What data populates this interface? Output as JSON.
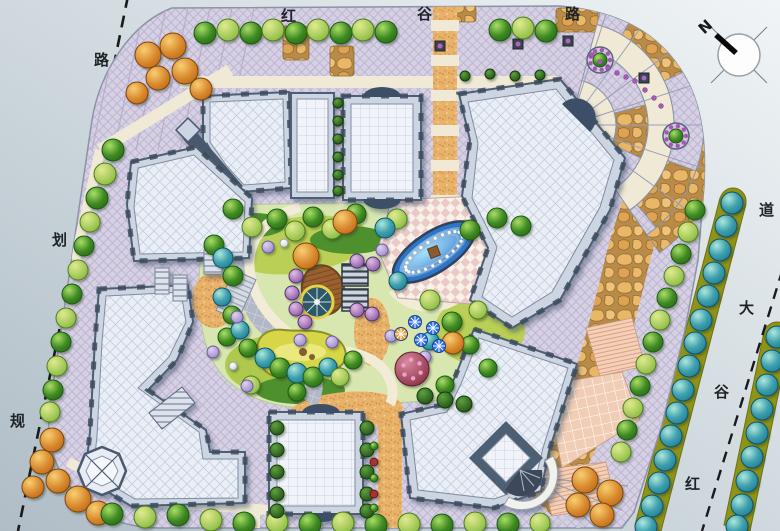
{
  "roads": {
    "top": {
      "name": "红谷路",
      "chars": [
        "红",
        "谷",
        "路"
      ]
    },
    "left": {
      "name": "规划路",
      "chars": [
        "路",
        "划",
        "规"
      ]
    },
    "right": {
      "name": "红谷大道",
      "chars": [
        "道",
        "大",
        "谷",
        "红"
      ]
    }
  },
  "compass": {
    "north_label": "N"
  },
  "palette": {
    "road_bg_dark": "#b5c1c9",
    "road_bg_light": "#eef2f5",
    "paving_lavender": "#d6d0e3",
    "paving_cream": "#efe9d5",
    "flagstone": "#e2a75f",
    "gravel": "#e9b26b",
    "roof_light": "#eaeef6",
    "roof_frame": "#4e5e72",
    "water_blue": "#2a70cc",
    "pond_green": "#d6d648",
    "lawn_green": "#b9cf55",
    "tree_green": "#3e8a22",
    "tree_teal": "#1f7f96",
    "tree_orange": "#c06a18",
    "tree_purple": "#8a55a0",
    "median_olive": "#8f9318",
    "umbrella_blue": "#2f6fe8",
    "dash_line": "#1a1a1a"
  },
  "trees": [
    [
      205,
      33,
      11,
      "g"
    ],
    [
      228,
      30,
      11,
      "l"
    ],
    [
      251,
      33,
      11,
      "g"
    ],
    [
      273,
      30,
      11,
      "l"
    ],
    [
      296,
      33,
      11,
      "g"
    ],
    [
      318,
      30,
      11,
      "l"
    ],
    [
      341,
      33,
      11,
      "g"
    ],
    [
      363,
      30,
      11,
      "l"
    ],
    [
      386,
      32,
      11,
      "g"
    ],
    [
      500,
      30,
      11,
      "g"
    ],
    [
      523,
      28,
      11,
      "l"
    ],
    [
      546,
      31,
      11,
      "g"
    ],
    [
      148,
      55,
      13,
      "o"
    ],
    [
      173,
      46,
      13,
      "o"
    ],
    [
      158,
      78,
      12,
      "o"
    ],
    [
      185,
      71,
      13,
      "o"
    ],
    [
      201,
      89,
      11,
      "o"
    ],
    [
      137,
      93,
      11,
      "o"
    ],
    [
      113,
      150,
      11,
      "g"
    ],
    [
      105,
      174,
      11,
      "l"
    ],
    [
      97,
      198,
      11,
      "g"
    ],
    [
      90,
      222,
      10,
      "l"
    ],
    [
      84,
      246,
      10,
      "g"
    ],
    [
      78,
      270,
      10,
      "l"
    ],
    [
      72,
      294,
      10,
      "g"
    ],
    [
      66,
      318,
      10,
      "l"
    ],
    [
      61,
      342,
      10,
      "g"
    ],
    [
      57,
      366,
      10,
      "l"
    ],
    [
      53,
      390,
      10,
      "g"
    ],
    [
      50,
      412,
      10,
      "l"
    ],
    [
      52,
      440,
      12,
      "o"
    ],
    [
      42,
      462,
      12,
      "o"
    ],
    [
      58,
      481,
      12,
      "o"
    ],
    [
      78,
      499,
      13,
      "o"
    ],
    [
      98,
      513,
      12,
      "o"
    ],
    [
      33,
      487,
      11,
      "o"
    ],
    [
      112,
      514,
      11,
      "g"
    ],
    [
      145,
      517,
      11,
      "l"
    ],
    [
      178,
      515,
      11,
      "g"
    ],
    [
      211,
      520,
      11,
      "l"
    ],
    [
      244,
      523,
      11,
      "g"
    ],
    [
      277,
      522,
      11,
      "l"
    ],
    [
      310,
      524,
      11,
      "g"
    ],
    [
      343,
      523,
      11,
      "l"
    ],
    [
      376,
      525,
      11,
      "g"
    ],
    [
      409,
      524,
      11,
      "l"
    ],
    [
      442,
      525,
      11,
      "g"
    ],
    [
      475,
      523,
      11,
      "l"
    ],
    [
      508,
      524,
      11,
      "g"
    ],
    [
      540,
      523,
      10,
      "l"
    ],
    [
      585,
      480,
      13,
      "o"
    ],
    [
      610,
      493,
      13,
      "o"
    ],
    [
      578,
      505,
      12,
      "o"
    ],
    [
      602,
      515,
      12,
      "o"
    ],
    [
      695,
      210,
      10,
      "g"
    ],
    [
      688,
      232,
      10,
      "l"
    ],
    [
      681,
      254,
      10,
      "g"
    ],
    [
      674,
      276,
      10,
      "l"
    ],
    [
      667,
      298,
      10,
      "g"
    ],
    [
      660,
      320,
      10,
      "l"
    ],
    [
      653,
      342,
      10,
      "g"
    ],
    [
      646,
      364,
      10,
      "l"
    ],
    [
      640,
      386,
      10,
      "g"
    ],
    [
      633,
      408,
      10,
      "l"
    ],
    [
      627,
      430,
      10,
      "g"
    ],
    [
      621,
      452,
      10,
      "l"
    ],
    [
      732,
      203,
      11,
      "t"
    ],
    [
      726,
      226,
      11,
      "t"
    ],
    [
      720,
      250,
      11,
      "t"
    ],
    [
      714,
      273,
      11,
      "t"
    ],
    [
      708,
      296,
      11,
      "t"
    ],
    [
      701,
      320,
      11,
      "t"
    ],
    [
      695,
      343,
      11,
      "t"
    ],
    [
      689,
      366,
      11,
      "t"
    ],
    [
      683,
      390,
      11,
      "t"
    ],
    [
      677,
      413,
      11,
      "t"
    ],
    [
      671,
      436,
      11,
      "t"
    ],
    [
      665,
      460,
      11,
      "t"
    ],
    [
      659,
      483,
      11,
      "t"
    ],
    [
      652,
      506,
      11,
      "t"
    ],
    [
      646,
      527,
      11,
      "t"
    ],
    [
      777,
      337,
      11,
      "t"
    ],
    [
      772,
      361,
      11,
      "t"
    ],
    [
      767,
      385,
      11,
      "t"
    ],
    [
      762,
      409,
      11,
      "t"
    ],
    [
      757,
      433,
      11,
      "t"
    ],
    [
      752,
      457,
      11,
      "t"
    ],
    [
      747,
      481,
      11,
      "t"
    ],
    [
      742,
      505,
      11,
      "t"
    ],
    [
      737,
      526,
      11,
      "t"
    ],
    [
      233,
      209,
      10,
      "g"
    ],
    [
      252,
      227,
      10,
      "l"
    ],
    [
      277,
      219,
      10,
      "g"
    ],
    [
      295,
      231,
      10,
      "l"
    ],
    [
      313,
      217,
      10,
      "g"
    ],
    [
      332,
      229,
      10,
      "l"
    ],
    [
      356,
      214,
      10,
      "g"
    ],
    [
      397,
      219,
      10,
      "l"
    ],
    [
      214,
      245,
      10,
      "g"
    ],
    [
      223,
      258,
      10,
      "t"
    ],
    [
      233,
      276,
      10,
      "g"
    ],
    [
      222,
      297,
      9,
      "t"
    ],
    [
      232,
      315,
      9,
      "g"
    ],
    [
      227,
      337,
      9,
      "g"
    ],
    [
      240,
      330,
      9,
      "t"
    ],
    [
      248,
      348,
      9,
      "g"
    ],
    [
      265,
      358,
      10,
      "t"
    ],
    [
      280,
      368,
      10,
      "g"
    ],
    [
      297,
      373,
      10,
      "t"
    ],
    [
      313,
      377,
      10,
      "g"
    ],
    [
      328,
      367,
      9,
      "t"
    ],
    [
      340,
      377,
      9,
      "l"
    ],
    [
      297,
      392,
      9,
      "g"
    ],
    [
      251,
      385,
      9,
      "l"
    ],
    [
      385,
      228,
      10,
      "t"
    ],
    [
      398,
      281,
      9,
      "t"
    ],
    [
      430,
      341,
      9,
      "t"
    ],
    [
      353,
      360,
      9,
      "g"
    ],
    [
      430,
      300,
      10,
      "l"
    ],
    [
      452,
      322,
      10,
      "g"
    ],
    [
      445,
      385,
      9,
      "g"
    ],
    [
      470,
      230,
      10,
      "g"
    ],
    [
      497,
      218,
      10,
      "g"
    ],
    [
      521,
      226,
      10,
      "g"
    ],
    [
      478,
      310,
      9,
      "l"
    ],
    [
      470,
      345,
      9,
      "g"
    ],
    [
      488,
      368,
      9,
      "g"
    ],
    [
      306,
      256,
      13,
      "o"
    ],
    [
      345,
      222,
      12,
      "o"
    ],
    [
      453,
      343,
      11,
      "o"
    ],
    [
      296,
      276,
      7,
      "p"
    ],
    [
      292,
      293,
      7,
      "p"
    ],
    [
      296,
      309,
      7,
      "p"
    ],
    [
      305,
      322,
      7,
      "p"
    ],
    [
      357,
      261,
      7,
      "p"
    ],
    [
      373,
      264,
      7,
      "p"
    ],
    [
      357,
      310,
      7,
      "p"
    ],
    [
      372,
      314,
      7,
      "p"
    ],
    [
      213,
      352,
      6,
      "v"
    ],
    [
      237,
      317,
      6,
      "v"
    ],
    [
      300,
      340,
      6,
      "v"
    ],
    [
      382,
      250,
      6,
      "v"
    ],
    [
      391,
      336,
      6,
      "v"
    ],
    [
      425,
      357,
      6,
      "v"
    ],
    [
      247,
      386,
      6,
      "v"
    ],
    [
      268,
      247,
      6,
      "v"
    ],
    [
      332,
      342,
      6,
      "v"
    ],
    [
      412,
      369,
      17,
      "m"
    ],
    [
      284,
      243,
      4,
      "w"
    ],
    [
      233,
      366,
      4,
      "w"
    ],
    [
      277,
      428,
      7,
      "d"
    ],
    [
      277,
      450,
      7,
      "d"
    ],
    [
      277,
      472,
      7,
      "d"
    ],
    [
      277,
      494,
      7,
      "d"
    ],
    [
      277,
      511,
      7,
      "d"
    ],
    [
      367,
      428,
      7,
      "d"
    ],
    [
      367,
      450,
      7,
      "d"
    ],
    [
      367,
      472,
      7,
      "d"
    ],
    [
      367,
      494,
      7,
      "d"
    ],
    [
      367,
      511,
      7,
      "d"
    ],
    [
      338,
      103,
      5,
      "d"
    ],
    [
      338,
      121,
      5,
      "d"
    ],
    [
      338,
      139,
      5,
      "d"
    ],
    [
      338,
      157,
      5,
      "d"
    ],
    [
      338,
      175,
      5,
      "d"
    ],
    [
      338,
      191,
      5,
      "d"
    ],
    [
      465,
      76,
      5,
      "d"
    ],
    [
      490,
      74,
      5,
      "d"
    ],
    [
      515,
      76,
      5,
      "d"
    ],
    [
      540,
      75,
      5,
      "d"
    ],
    [
      425,
      396,
      8,
      "d"
    ],
    [
      445,
      400,
      8,
      "d"
    ],
    [
      464,
      404,
      8,
      "d"
    ],
    [
      374,
      446,
      4,
      "g"
    ],
    [
      374,
      462,
      4,
      "r"
    ],
    [
      374,
      478,
      4,
      "g"
    ],
    [
      374,
      494,
      4,
      "r"
    ],
    [
      374,
      508,
      4,
      "g"
    ]
  ],
  "umbrellas": [
    {
      "x": 415,
      "y": 322,
      "color": "#2f6fe8"
    },
    {
      "x": 433,
      "y": 328,
      "color": "#2f6fe8"
    },
    {
      "x": 421,
      "y": 340,
      "color": "#2f6fe8"
    },
    {
      "x": 439,
      "y": 346,
      "color": "#2f6fe8"
    },
    {
      "x": 401,
      "y": 334,
      "color": "#e8a030"
    }
  ],
  "round_planters": [
    {
      "x": 600,
      "y": 60
    },
    {
      "x": 676,
      "y": 136
    }
  ],
  "square_planters": [
    {
      "x": 568,
      "y": 41
    },
    {
      "x": 644,
      "y": 78
    },
    {
      "x": 440,
      "y": 46
    },
    {
      "x": 518,
      "y": 44
    }
  ],
  "flower_dots": [
    [
      592,
      55
    ],
    [
      600,
      62
    ],
    [
      608,
      68
    ],
    [
      617,
      73
    ],
    [
      626,
      77
    ],
    [
      635,
      81
    ],
    [
      645,
      90
    ],
    [
      654,
      98
    ],
    [
      661,
      106
    ]
  ]
}
